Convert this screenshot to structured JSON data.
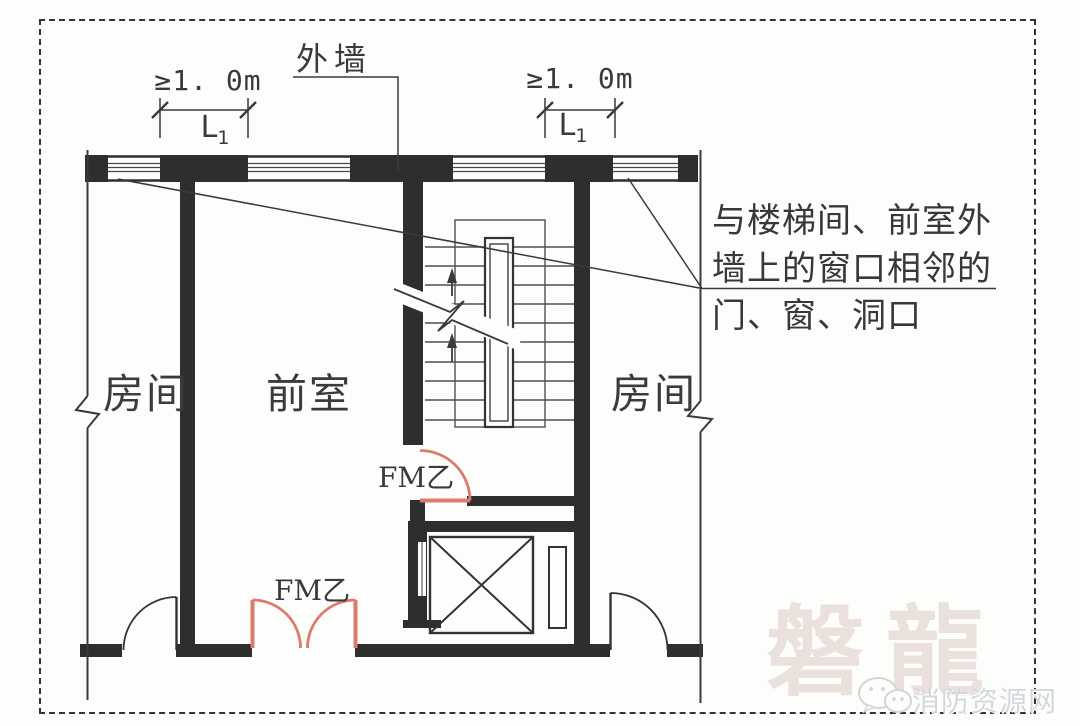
{
  "figure": {
    "exterior_wall_label": "外墙",
    "dim_left": {
      "value": "≥1. 0m",
      "length_main": "L",
      "length_sub": "1"
    },
    "dim_right": {
      "value": "≥1. 0m",
      "length_main": "L",
      "length_sub": "1"
    },
    "room_left": "房间",
    "anteroom": "前室",
    "room_right": "房间",
    "fire_door_single": "FM乙",
    "fire_door_double": "FM乙",
    "annotation_line1": "与楼梯间、前室外",
    "annotation_line2": "墙上的窗口相邻的",
    "annotation_line3": "门、窗、洞口",
    "colors": {
      "fire_door": "#dd7b6b",
      "ink": "#333333",
      "watermark_brand": "#d0bab3",
      "watermark_site": "#d2d8dc"
    }
  },
  "watermark": {
    "brand": "磐龍",
    "site": "消防资源网"
  }
}
